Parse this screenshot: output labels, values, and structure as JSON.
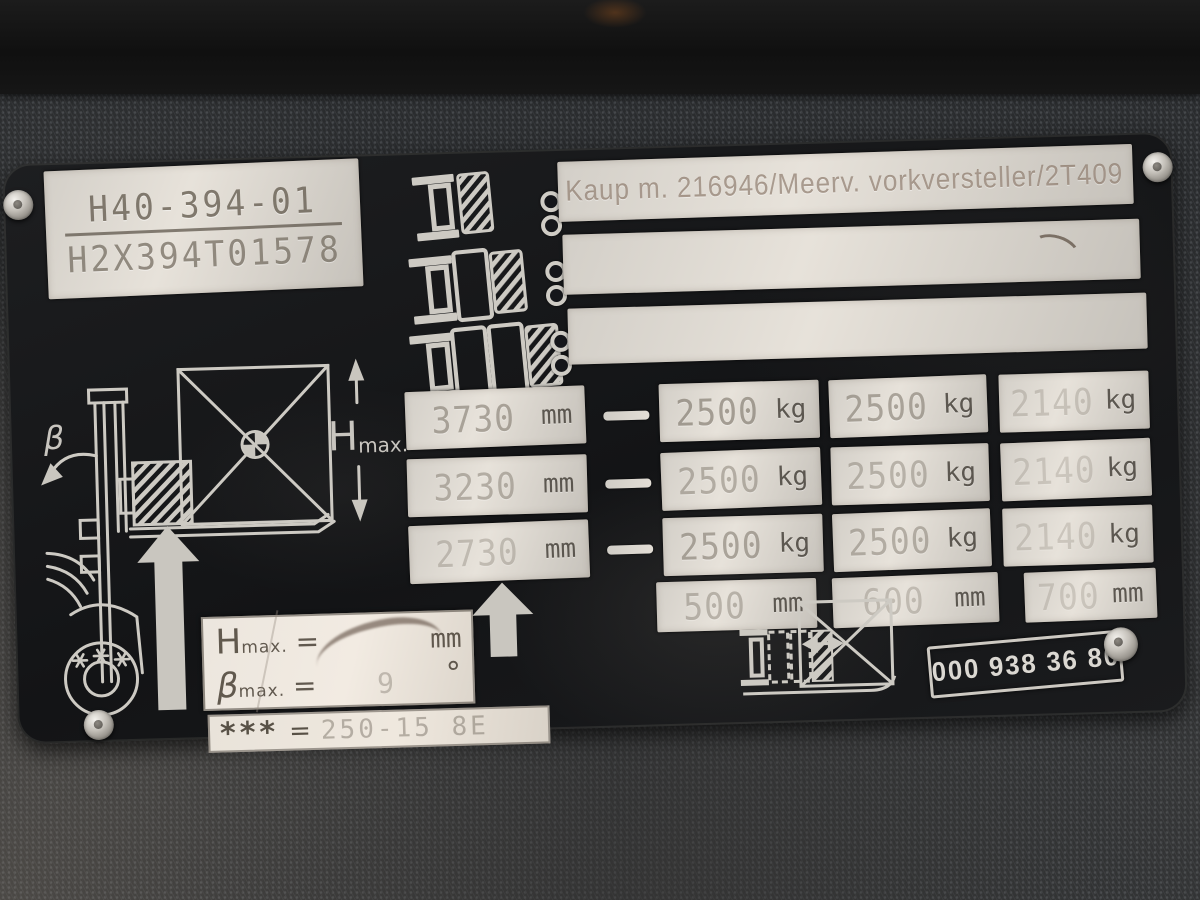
{
  "plate": {
    "serial_box": {
      "model": "H40-394-01",
      "serial": "H2X394T01578"
    },
    "header_strip": {
      "line1": "Kaup m. 216946/Meerv. vorkversteller/2T409"
    },
    "capacity_table": {
      "rows": [
        {
          "height": "3730",
          "height_unit": "mm",
          "load1": "2500",
          "load1_unit": "kg",
          "load2": "2500",
          "load2_unit": "kg",
          "load3": "2140",
          "load3_unit": "kg"
        },
        {
          "height": "3230",
          "height_unit": "mm",
          "load1": "2500",
          "load1_unit": "kg",
          "load2": "2500",
          "load2_unit": "kg",
          "load3": "2140",
          "load3_unit": "kg"
        },
        {
          "height": "2730",
          "height_unit": "mm",
          "load1": "2500",
          "load1_unit": "kg",
          "load2": "2500",
          "load2_unit": "kg",
          "load3": "2140",
          "load3_unit": "kg"
        }
      ],
      "load_centers": [
        {
          "value": "500",
          "unit": "mm"
        },
        {
          "value": "600",
          "unit": "mm"
        },
        {
          "value": "700",
          "unit": "mm"
        }
      ]
    },
    "specs": {
      "hmax_main": "H",
      "hmax_sub": "max.",
      "eq": "=",
      "hmax_value": "",
      "hmax_unit": "mm",
      "beta_main": "β",
      "beta_sub": "max.",
      "beta_value": "9",
      "beta_unit": "°",
      "stars_label": "***",
      "stars_value": "250-15  8E"
    },
    "part_number": "000 938 36 80",
    "diagram": {
      "beta_symbol": "β",
      "hmax_main": "H",
      "hmax_sub": "max."
    },
    "icons": {
      "fork_load_1": "side fork carrying 1 hatched load block",
      "fork_load_2": "side fork carrying 2 load blocks",
      "fork_load_3": "side fork carrying 3 load blocks",
      "lift_arrow": "upward block arrow",
      "fork_positioner": "fork positioner with load square and double arrow",
      "forklift_diagram": "forklift side view with load square, Hmax arrows, tilt angle and wheel"
    }
  }
}
